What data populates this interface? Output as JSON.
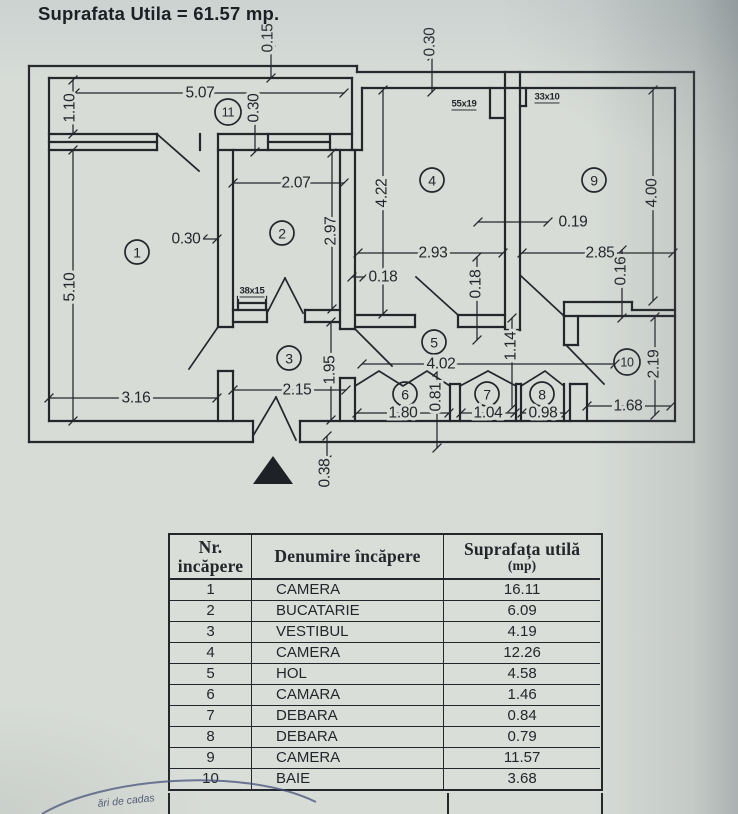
{
  "colors": {
    "paper": "#d7dcd7",
    "ink": "#23262b",
    "stamp": "#45507a"
  },
  "plan": {
    "room_circles": [
      {
        "n": "1",
        "x": 137,
        "y": 252
      },
      {
        "n": "2",
        "x": 282,
        "y": 233
      },
      {
        "n": "3",
        "x": 289,
        "y": 358
      },
      {
        "n": "4",
        "x": 432,
        "y": 180
      },
      {
        "n": "5",
        "x": 434,
        "y": 342
      },
      {
        "n": "6",
        "x": 405,
        "y": 394
      },
      {
        "n": "7",
        "x": 487,
        "y": 394
      },
      {
        "n": "8",
        "x": 542,
        "y": 394
      },
      {
        "n": "9",
        "x": 594,
        "y": 180
      },
      {
        "n": "10",
        "x": 627,
        "y": 362
      },
      {
        "n": "11",
        "x": 228,
        "y": 112
      }
    ],
    "dim_labels": [
      {
        "t": "0.15",
        "x": 268,
        "y": 38,
        "r": -90
      },
      {
        "t": "0.30",
        "x": 430,
        "y": 42,
        "r": -90
      },
      {
        "t": "5.07",
        "x": 200,
        "y": 93,
        "r": 0
      },
      {
        "t": "1.10",
        "x": 70,
        "y": 108,
        "r": -90
      },
      {
        "t": "0.30",
        "x": 254,
        "y": 108,
        "r": -90
      },
      {
        "t": "2.07",
        "x": 296,
        "y": 183,
        "r": 0
      },
      {
        "t": "2.97",
        "x": 331,
        "y": 231,
        "r": -90
      },
      {
        "t": "4.22",
        "x": 382,
        "y": 193,
        "r": -90
      },
      {
        "t": "4.00",
        "x": 652,
        "y": 193,
        "r": -90
      },
      {
        "t": "0.19",
        "x": 573,
        "y": 222,
        "r": 0
      },
      {
        "t": "2.93",
        "x": 433,
        "y": 253,
        "r": 0
      },
      {
        "t": "2.85",
        "x": 600,
        "y": 253,
        "r": 0
      },
      {
        "t": "0.30",
        "x": 186,
        "y": 239,
        "r": 0
      },
      {
        "t": "0.18",
        "x": 383,
        "y": 277,
        "r": 0
      },
      {
        "t": "0.18",
        "x": 476,
        "y": 284,
        "r": -90
      },
      {
        "t": "0.16",
        "x": 621,
        "y": 271,
        "r": -90
      },
      {
        "t": "5.10",
        "x": 70,
        "y": 287,
        "r": -90
      },
      {
        "t": "1.95",
        "x": 330,
        "y": 370,
        "r": -90
      },
      {
        "t": "2.15",
        "x": 297,
        "y": 390,
        "r": 0
      },
      {
        "t": "3.16",
        "x": 136,
        "y": 398,
        "r": 0
      },
      {
        "t": "4.02",
        "x": 441,
        "y": 364,
        "r": 0
      },
      {
        "t": "1.14",
        "x": 511,
        "y": 346,
        "r": -90
      },
      {
        "t": "2.19",
        "x": 654,
        "y": 364,
        "r": -90
      },
      {
        "t": "0.81",
        "x": 436,
        "y": 397,
        "r": -90
      },
      {
        "t": "1.80",
        "x": 403,
        "y": 413,
        "r": 0
      },
      {
        "t": "1.04",
        "x": 488,
        "y": 413,
        "r": 0
      },
      {
        "t": "0.98",
        "x": 543,
        "y": 413,
        "r": 0
      },
      {
        "t": "1.68",
        "x": 628,
        "y": 406,
        "r": 0
      },
      {
        "t": "0.38",
        "x": 325,
        "y": 473,
        "r": -90
      }
    ],
    "pillar_labels": [
      {
        "t": "55x19",
        "x": 464,
        "y": 104
      },
      {
        "t": "33x10",
        "x": 547,
        "y": 97
      },
      {
        "t": "38x15",
        "x": 252,
        "y": 291
      }
    ]
  },
  "table": {
    "col1_header_line1": "Nr.",
    "col1_header_line2": "incăpere",
    "col2_header": "Denumire încăpere",
    "col3_header_line1": "Suprafața utilă",
    "col3_header_line2": "(mp)",
    "rows": [
      [
        "1",
        "CAMERA",
        "16.11"
      ],
      [
        "2",
        "BUCATARIE",
        "6.09"
      ],
      [
        "3",
        "VESTIBUL",
        "4.19"
      ],
      [
        "4",
        "CAMERA",
        "12.26"
      ],
      [
        "5",
        "HOL",
        "4.58"
      ],
      [
        "6",
        "CAMARA",
        "1.46"
      ],
      [
        "7",
        "DEBARA",
        "0.84"
      ],
      [
        "8",
        "DEBARA",
        "0.79"
      ],
      [
        "9",
        "CAMERA",
        "11.57"
      ],
      [
        "10",
        "BAIE",
        "3.68"
      ]
    ],
    "footer": "Suprafata Utila = 61.57 mp."
  },
  "stamp": {
    "text": "ări de cadas"
  }
}
